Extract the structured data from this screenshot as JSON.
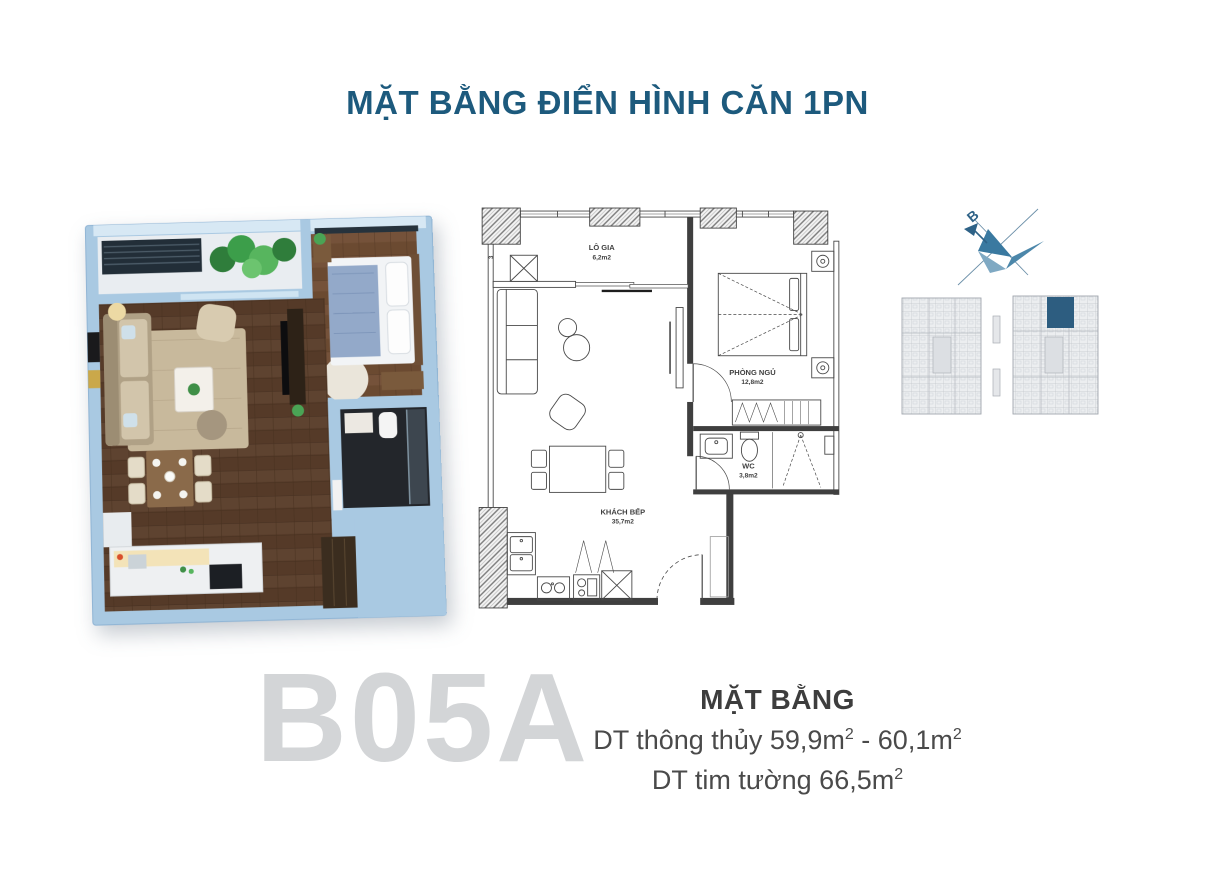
{
  "header": {
    "title": "MẶT BẰNG ĐIỂN HÌNH CĂN 1PN",
    "title_color": "#1d5a7d"
  },
  "unit": {
    "code": "B05A",
    "code_color": "#d3d5d7"
  },
  "plan2d": {
    "rooms": {
      "logia": {
        "name": "LÔ GIA",
        "area": "6,2m2"
      },
      "bedroom": {
        "name": "PHÒNG NGỦ",
        "area": "12,8m2"
      },
      "wc": {
        "name": "WC",
        "area": "3,8m2"
      },
      "living": {
        "name": "KHÁCH BẾP",
        "area": "35,7m2"
      }
    },
    "grid_label": "3"
  },
  "compass": {
    "north_label": "B"
  },
  "keyplan": {
    "highlight_color": "#2d5d80"
  },
  "summary": {
    "heading": "MẶT BẰNG",
    "net_area": {
      "prefix": "DT thông thủy 59,9m",
      "sup1": "2",
      "middle": " - 60,1m",
      "sup2": "2"
    },
    "wall_area": {
      "prefix": "DT tim tường 66,5m",
      "sup": "2"
    }
  }
}
